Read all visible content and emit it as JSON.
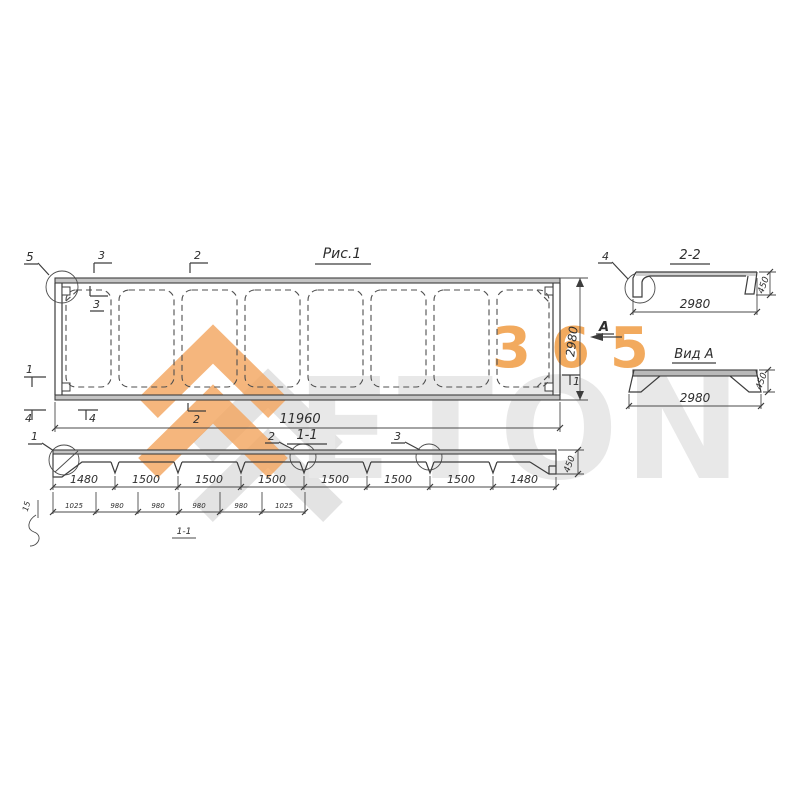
{
  "brand": {
    "word": "ETON",
    "number": "365",
    "orange": "#F1A14D",
    "gray": "#E8E8E8"
  },
  "figure_title": "Рис.1",
  "plan": {
    "length": "11960",
    "width": "2980",
    "view_label": "А",
    "callout_corner": "5",
    "cut3_top": "3",
    "cut2_top": "2",
    "cut3_inner": "3",
    "cut1_left": "1",
    "cut1_right": "1",
    "cut4_a": "4",
    "cut4_b": "4",
    "cut2_bottom": "2"
  },
  "section_1_1": {
    "title": "1-1",
    "sub_title": "1-1",
    "callout_1": "1",
    "callout_2": "2",
    "callout_3": "3",
    "height": "450",
    "offset": "15",
    "dims_top": [
      "1480",
      "1500",
      "1500",
      "1500",
      "1500",
      "1500",
      "1500",
      "1480"
    ],
    "dims_bottom": [
      "1025",
      "980",
      "980",
      "980",
      "980",
      "1025"
    ]
  },
  "section_2_2": {
    "title": "2-2",
    "callout_4": "4",
    "width": "2980",
    "height": "450"
  },
  "view_a": {
    "title": "Вид А",
    "width": "2980",
    "height": "450"
  }
}
